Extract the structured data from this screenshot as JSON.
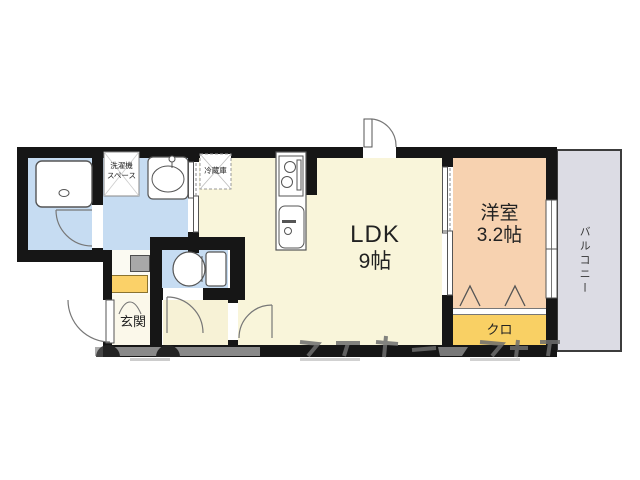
{
  "floorplan": {
    "rooms": {
      "ldk": {
        "label": "LDK",
        "size": "9帖"
      },
      "western_room": {
        "label": "洋室",
        "size": "3.2帖"
      },
      "balcony": {
        "label": "バルコニー"
      },
      "closet": {
        "label": "クロ"
      },
      "entrance": {
        "label": "玄関"
      },
      "refrigerator": {
        "label": "冷蔵庫"
      },
      "washer_space": {
        "line1": "洗濯機",
        "line2": "スペース"
      }
    },
    "colors": {
      "wall": "#161616",
      "water_blue": "#c6dcf2",
      "ldk_cream": "#f9f5da",
      "hall_cream": "#f7f2d6",
      "room_peach": "#f7d2b0",
      "closet_yellow": "#f9d064",
      "balcony_gray": "#dcdce4"
    }
  }
}
